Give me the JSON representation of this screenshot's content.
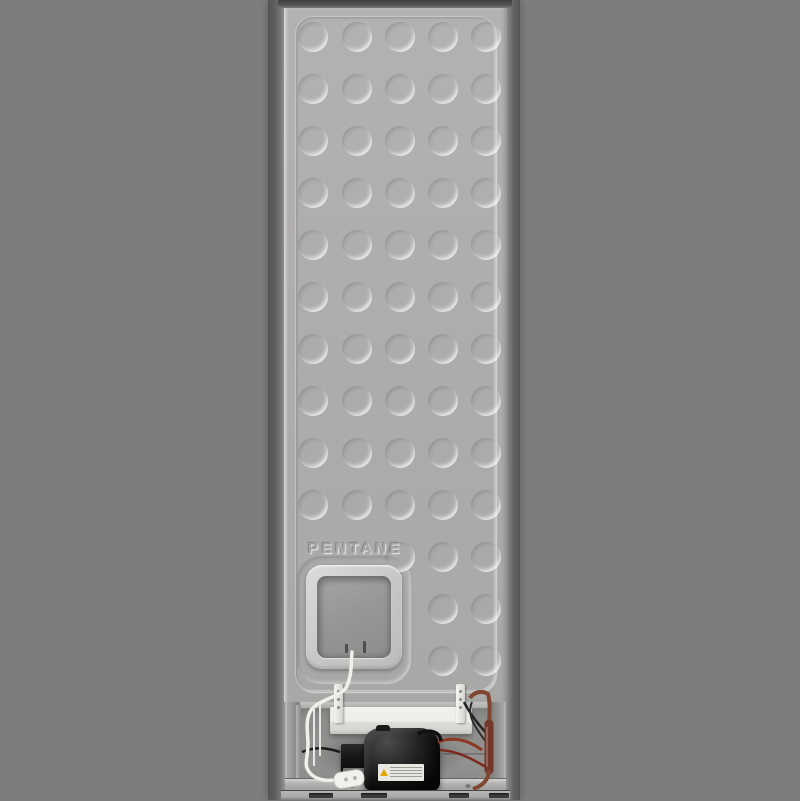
{
  "scene": {
    "type": "product-photo",
    "subject": "refrigerator rear view",
    "background_color": "#7d7d7d"
  },
  "panel": {
    "marking": "PENTANE",
    "color": "#aeadab",
    "dimple_grid": {
      "rows": 13,
      "cols": 5,
      "hidden": [
        [
          10,
          0
        ],
        [
          10,
          1
        ],
        [
          11,
          0
        ],
        [
          11,
          1
        ],
        [
          11,
          2
        ],
        [
          12,
          0
        ],
        [
          12,
          1
        ],
        [
          12,
          2
        ]
      ]
    }
  },
  "compartment": {
    "parts": [
      "drip-tray",
      "compressor",
      "relay-box",
      "power-cord",
      "power-plug",
      "copper-drier-tube",
      "bottom-cross-rail",
      "base-rail"
    ],
    "vent_slot_count": 4
  },
  "compressor": {
    "body_color": "#161616",
    "label_warning_icon": "warning-triangle-icon"
  },
  "materials": {
    "copper_tube_color": "#7c4028",
    "cord_color": "#efefec",
    "tray_color": "#eeede9"
  }
}
